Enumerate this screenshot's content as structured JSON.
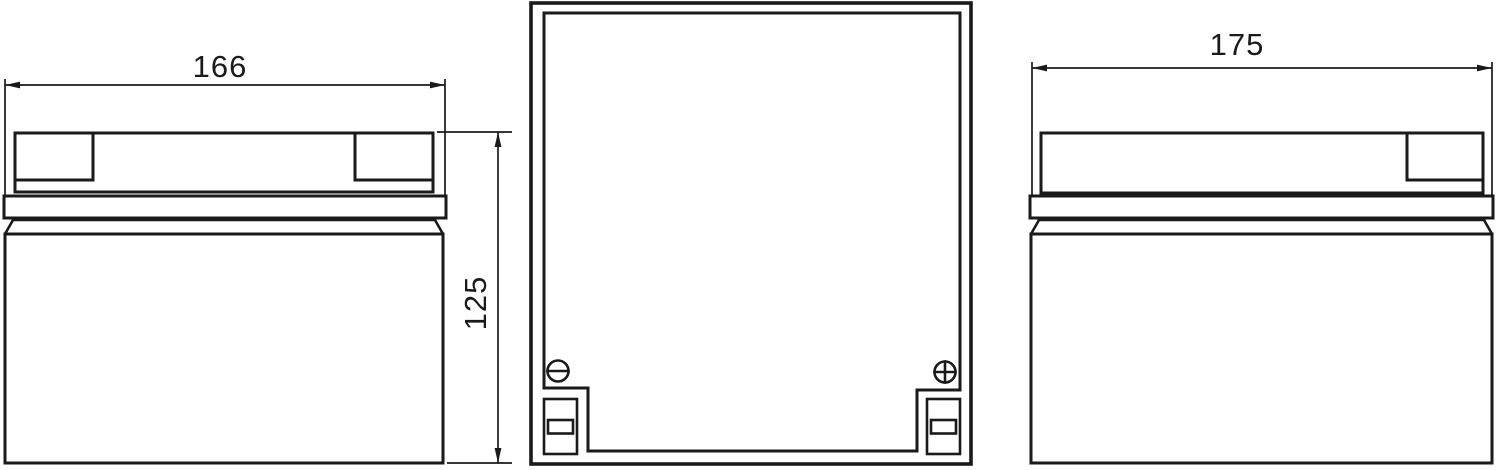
{
  "colors": {
    "background": "#ffffff",
    "line": "#1a1a1a"
  },
  "dimensions": {
    "front_width_mm": "166",
    "front_height_mm": "125",
    "side_width_mm": "175"
  },
  "icons": {
    "negative_terminal": "minus-screw-terminal-icon",
    "positive_terminal": "plus-screw-terminal-icon"
  }
}
